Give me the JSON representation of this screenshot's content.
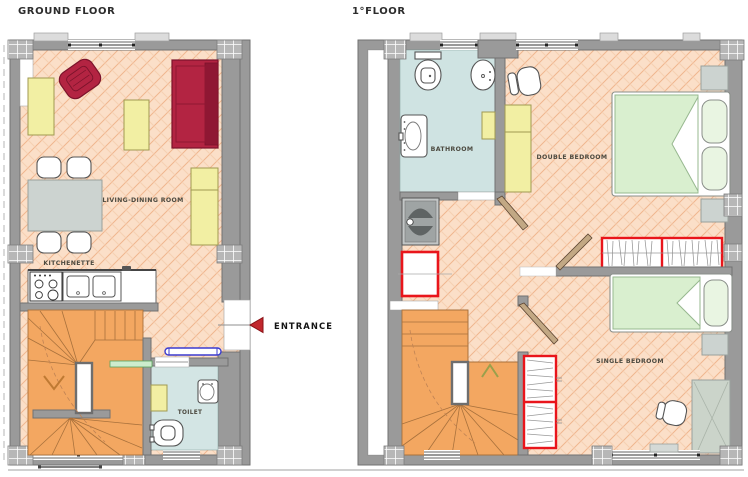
{
  "ground_floor": {
    "title": "GROUND FLOOR",
    "labels": {
      "living_dining": "LIVING-DINING ROOM",
      "kitchenette": "KITCHENETTE",
      "toilet": "TOILET",
      "entrance": "ENTRANCE"
    },
    "furniture": [
      "armchair",
      "sofa",
      "coffee-table",
      "sideboard",
      "side-table",
      "dining-table",
      "chairs",
      "stove",
      "kitchen-sink",
      "counter",
      "staircase",
      "toilet",
      "washbasin",
      "radiator"
    ]
  },
  "first_floor": {
    "title": "1°FLOOR",
    "labels": {
      "bathroom": "BATHROOM",
      "double_bedroom": "DOUBLE BEDROOM",
      "single_bedroom": "SINGLE BEDROOM"
    },
    "furniture": [
      "toilet",
      "bidet",
      "washbasin",
      "shower",
      "double-bed",
      "nightstands",
      "wardrobe",
      "chair",
      "single-bed",
      "desk",
      "hanging-wardrobe",
      "shelving",
      "staircase"
    ]
  },
  "colors": {
    "floor_tile": "#fbdfc8",
    "tile_line": "#f0b68e",
    "wall": "#9a9a9a",
    "stairs": "#f3a761",
    "wet_floor": "#d3e5e4",
    "furniture_yellow": "#f2efa3",
    "sofa_red": "#b32442",
    "bed_green": "#d9efcf",
    "accent_red": "#e9151b",
    "entrance_arrow": "#c1272d",
    "radiator_blue": "#3c3ccf"
  }
}
